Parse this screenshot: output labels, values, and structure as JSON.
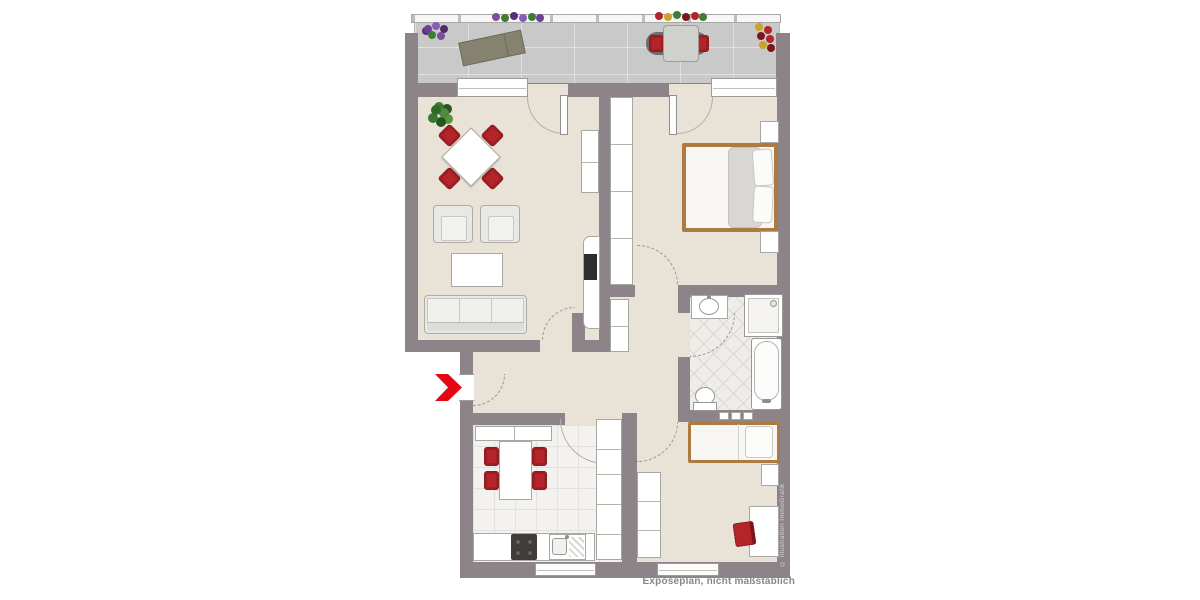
{
  "texts": {
    "caption": "Exposéplan, nicht maßstäblich",
    "copyright": "© Illustration ImmoGrafik"
  },
  "palette": {
    "wall": "#8d8489",
    "floor_beige": "#e9e3d7",
    "balcony_tile": "#c9c9c9",
    "bath_tile": "#efede9",
    "kitchen_tile": "#f3f2ef",
    "accent_red_furniture": "#b42428",
    "entrance_arrow_red": "#e30613",
    "bed_frame_wood": "#ad7a42",
    "furniture_white": "#ffffff",
    "furniture_gray": "#e8e8e4"
  },
  "rooms": [
    {
      "key": "balcony",
      "items": [
        "railing with planters",
        "purple-flower planter",
        "sun lounger",
        "bistro table with two red chairs",
        "red-yellow flower pot"
      ]
    },
    {
      "key": "living-room",
      "items": [
        "potted plant",
        "square dining table with four red chairs",
        "two armchairs",
        "coffee table",
        "three-seat sofa",
        "sideboard",
        "tv lowboard with tv"
      ]
    },
    {
      "key": "bedroom",
      "items": [
        "wardrobe",
        "double bed with duvet and pillows",
        "two nightstands"
      ]
    },
    {
      "key": "hallway",
      "items": [
        "entrance arrow",
        "hall closet"
      ]
    },
    {
      "key": "bathroom",
      "items": [
        "washbasin",
        "shower",
        "bathtub",
        "toilet",
        "wall niche"
      ]
    },
    {
      "key": "kitchen",
      "items": [
        "counter",
        "dining table with four red chairs",
        "stove",
        "sink with drainboard",
        "tall cabinet column"
      ]
    },
    {
      "key": "kids-room",
      "items": [
        "wardrobe",
        "single bed",
        "nightstand",
        "desk",
        "red desk chair"
      ]
    }
  ],
  "doors": [
    "entrance",
    "living-room",
    "bedroom",
    "bathroom",
    "kids-room",
    "kitchen",
    "balcony-living",
    "balcony-bedroom"
  ],
  "windows": [
    "living-room-balcony",
    "bedroom-balcony",
    "kitchen-south",
    "kids-room-south"
  ]
}
